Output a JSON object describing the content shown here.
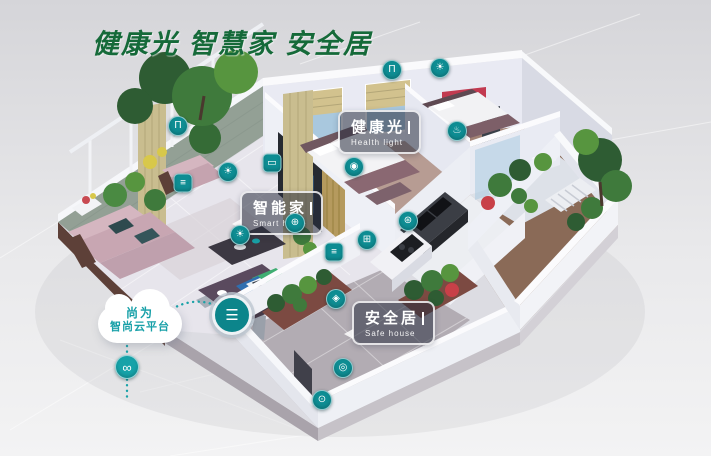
{
  "title": {
    "text": "健康光 智慧家 安全居"
  },
  "cloud": {
    "line1": "尚为",
    "line2": "智尚云平台"
  },
  "callouts": {
    "health_light": {
      "zh": "健康光",
      "en": "Health light"
    },
    "smart_home": {
      "zh": "智能家",
      "en": "Smart home"
    },
    "safe_house": {
      "zh": "安全居",
      "en": "Safe house"
    }
  },
  "colors": {
    "title_green": "#156a39",
    "device_teal": "#0e8d93",
    "cloud_text_teal": "#17a0a8",
    "callout_bg": "rgba(40,46,62,0.55)",
    "callout_border": "rgba(255,255,255,0.82)"
  },
  "device_icons": [
    {
      "name": "curtain-blind-icon",
      "glyph": "Π",
      "x": 392,
      "y": 70,
      "shape": "circle"
    },
    {
      "name": "downlight-icon",
      "glyph": "☀",
      "x": 440,
      "y": 68,
      "shape": "circle"
    },
    {
      "name": "water-heater-icon",
      "glyph": "♨",
      "x": 457,
      "y": 131,
      "shape": "circle"
    },
    {
      "name": "curtain-blind-icon",
      "glyph": "Π",
      "x": 178,
      "y": 126,
      "shape": "circle"
    },
    {
      "name": "ceiling-light-icon",
      "glyph": "☀",
      "x": 228,
      "y": 172,
      "shape": "circle"
    },
    {
      "name": "control-panel-icon",
      "glyph": "≡",
      "x": 183,
      "y": 183,
      "shape": "square"
    },
    {
      "name": "smart-tv-icon",
      "glyph": "▭",
      "x": 272,
      "y": 163,
      "shape": "square"
    },
    {
      "name": "floor-lamp-icon",
      "glyph": "☀",
      "x": 240,
      "y": 235,
      "shape": "circle"
    },
    {
      "name": "smart-socket-icon",
      "glyph": "⊕",
      "x": 295,
      "y": 223,
      "shape": "circle"
    },
    {
      "name": "scene-switch-icon",
      "glyph": "◉",
      "x": 354,
      "y": 167,
      "shape": "circle"
    },
    {
      "name": "stove-sensor-icon",
      "glyph": "⊞",
      "x": 367,
      "y": 240,
      "shape": "circle"
    },
    {
      "name": "range-hood-icon",
      "glyph": "⊛",
      "x": 408,
      "y": 221,
      "shape": "circle"
    },
    {
      "name": "wall-switch-icon",
      "glyph": "≡",
      "x": 334,
      "y": 252,
      "shape": "square"
    },
    {
      "name": "motion-sensor-icon",
      "glyph": "◈",
      "x": 336,
      "y": 299,
      "shape": "circle"
    },
    {
      "name": "security-camera-icon",
      "glyph": "◎",
      "x": 343,
      "y": 368,
      "shape": "circle"
    },
    {
      "name": "door-lock-icon",
      "glyph": "⊙",
      "x": 322,
      "y": 400,
      "shape": "circle"
    },
    {
      "name": "cloud-link-icon",
      "glyph": "∞",
      "x": 127,
      "y": 367,
      "shape": "circle-lg"
    },
    {
      "name": "hub-gateway-icon",
      "glyph": "☰",
      "x": 232,
      "y": 315,
      "shape": "hub"
    }
  ]
}
